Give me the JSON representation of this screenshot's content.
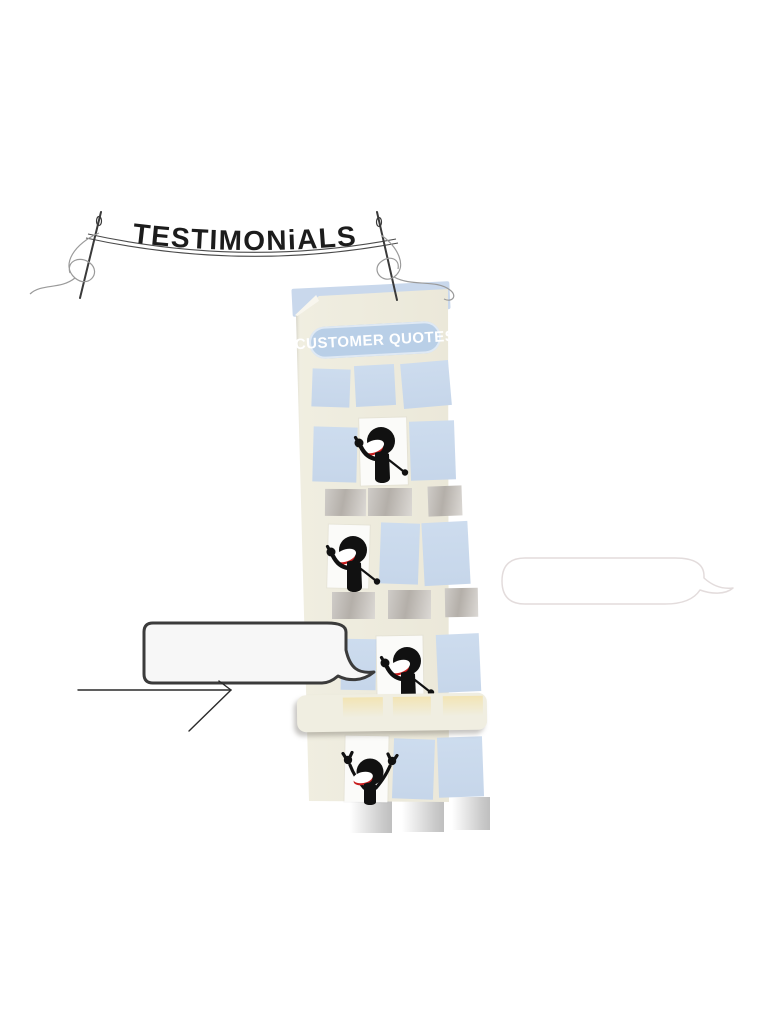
{
  "banner": {
    "title": "TESTIMONiALS"
  },
  "building": {
    "sign": "CUSTOMER QUOTES",
    "figures": [
      {
        "pose": "waving",
        "window": "upper floor white window"
      },
      {
        "pose": "waving",
        "window": "middle floor white window"
      },
      {
        "pose": "waving",
        "window": "lower floor white window"
      },
      {
        "pose": "cheering",
        "window": "bottom floor white window"
      }
    ],
    "windows": {
      "blue_count": 11,
      "white_count": 4,
      "gray_count": 9,
      "yellow_count": 3
    }
  },
  "speech_bubbles": {
    "left": {
      "text": ""
    },
    "right": {
      "text": ""
    }
  },
  "colors": {
    "page_bg": "#ffffff",
    "building_body": "#f0eee1",
    "roof_blue": "#c9d8ec",
    "window_blue": "#c6d6ea",
    "window_gray_a": "#b4afa9",
    "window_gray_b": "#dcd9d5",
    "window_yellow": "#f2e4b4",
    "bottom_window_gray": "#c9c9c9",
    "sign_bg": "#b9cfe7",
    "sign_text": "#ffffff",
    "banner_text": "#1c1c1c",
    "thread": "#9a9a9a",
    "needle": "#3a3a3a",
    "figure": "#111111",
    "figure_lip": "#c81e1e",
    "bubble_border": "#3b3b3b",
    "bubble_fill": "#f7f7f7",
    "faint_bubble_border": "#e3dcdc"
  }
}
